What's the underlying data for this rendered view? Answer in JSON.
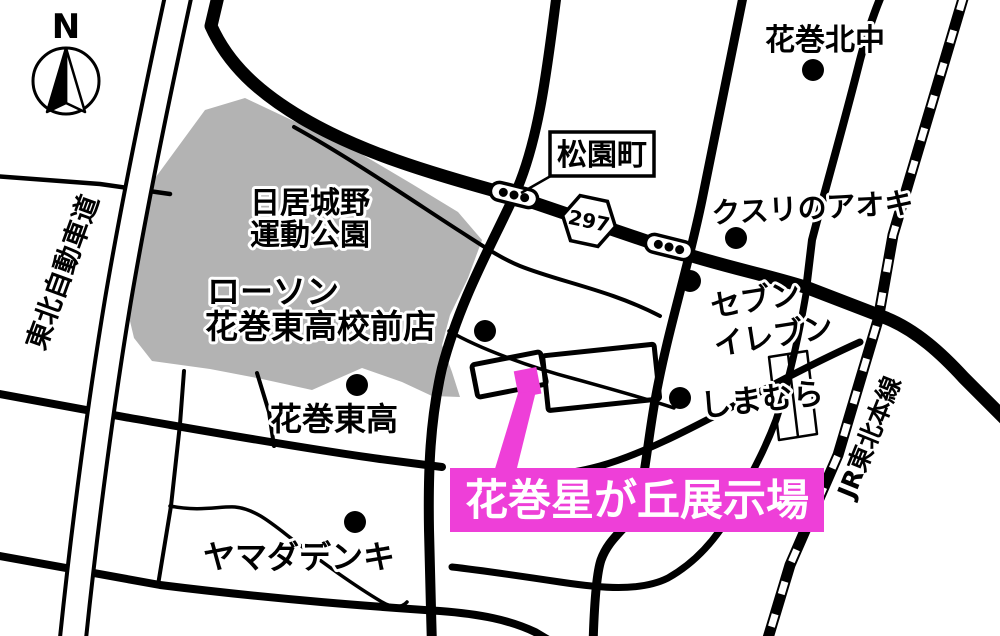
{
  "compass": {
    "north_label": "N"
  },
  "roads": {
    "expressway_label": "東北自動車道",
    "route_number": "297",
    "railway_label": "JR東北本線"
  },
  "landmarks": {
    "matsuzono": "松園町",
    "park_line1": "日居城野",
    "park_line2": "運動公園",
    "lawson_line1": "ローソン",
    "lawson_line2": "花巻東高校前店",
    "school_east": "花巻東高",
    "yamada": "ヤマダデンキ",
    "junior_high": "花巻北中",
    "kusuri_aoki": "クスリのアオキ",
    "seven_line1": "セブン",
    "seven_line2": "イレブン",
    "shimamura": "しまむら"
  },
  "destination": {
    "label": "花巻星が丘展示場"
  },
  "colors": {
    "magenta": "#ee3fd8",
    "park_gray": "#b3b3b3"
  }
}
